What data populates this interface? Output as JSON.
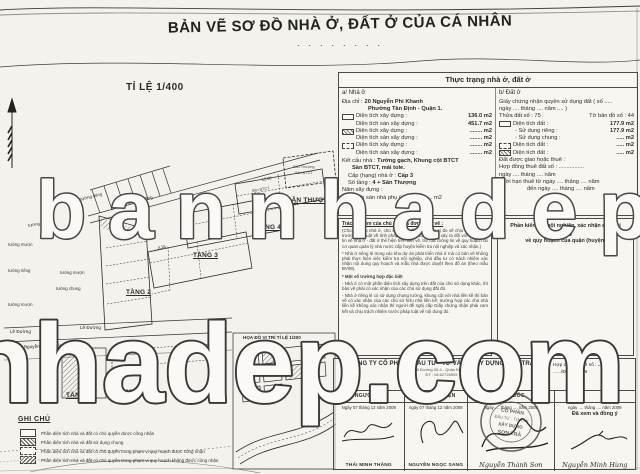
{
  "title": {
    "text": "BẢN VẼ SƠ ĐỒ NHÀ Ở, ĐẤT Ở CỦA CÁ NHÂN",
    "dots": "· · ·   · · · · ·"
  },
  "watermark": {
    "line1": "bannhadep.com",
    "line2": "nhadep.com"
  },
  "plan": {
    "scale_label": "TỈ LỆ 1/400",
    "location_map_label": "HỌA ĐỒ VỊ TRÍ TỈ LỆ 1/200",
    "floor_labels": [
      "TẦNG 1",
      "TẦNG 2",
      "TẦNG 3",
      "TẦNG 4",
      "SÂN THƯỢNG"
    ],
    "street_left": "Lề Đường",
    "street_right": "Lề Đường",
    "street_name": "Đường Nguyễn Phi Khanh",
    "alley_label": "hẻm xi măng",
    "slab_label": "Sàn BTCT",
    "roof_lines": [
      "Sân Thượng",
      "Sàn BTCT"
    ],
    "wall_labels": [
      "tường riêng",
      "tường mượn",
      "tường riêng",
      "tường mượn",
      "tường chung",
      "tường mượn",
      "tường riêng"
    ],
    "dims": [
      "10.00",
      "12.00",
      "4.10",
      "3.96"
    ]
  },
  "form": {
    "header": "Thực trạng nhà ở, đất ở",
    "house": {
      "section": "a/ Nhà ở",
      "address_label": "Địa chỉ :",
      "address1": "20 Nguyễn Phi Khanh",
      "address2": "Phường Tân Định - Quận 1.",
      "rows": [
        {
          "label": "Diện tích xây dựng :",
          "value": "136.0 m2"
        },
        {
          "label": "Diện tích sàn xây dựng :",
          "value": "451.7 m2"
        },
        {
          "label": "Diện tích xây dựng :",
          "value": "........ m2"
        },
        {
          "label": "Diện tích sàn xây dựng :",
          "value": "........ m2"
        },
        {
          "label": "Diện tích xây dựng :",
          "value": "........ m2"
        },
        {
          "label": "Diện tích sàn xây dựng :",
          "value": "........ m2"
        }
      ],
      "structure_label": "Kết cấu nhà :",
      "structure_value": "Tường gạch, Khung cột BTCT",
      "structure_value2": "Sàn BTCT, mái tole.",
      "grade_label": "Cấp (hạng) nhà ở :",
      "grade_value": "Cấp 3",
      "floors_label": "Số tầng :",
      "floors_value": "4 + Sân Thượng",
      "year_label": "Năm xây dựng :",
      "aux_label": "Diện tích sàn nhà phụ (nếu có) ....... m2"
    },
    "land": {
      "section": "b/ Đất ở",
      "cert1": "Giấy chứng nhận quyền sử dụng đất ( số .....",
      "cert2": "ngày .... tháng .... năm .... )",
      "parcel": "Thửa đất số : 75",
      "sheet": "Tờ bản đồ số : 44",
      "rows": [
        {
          "label": "Diện tích đất :",
          "value": "177.9 m2"
        },
        {
          "label": "- Sử dụng riêng :",
          "value": "177.9 m2"
        },
        {
          "label": "- Sử dụng chung :",
          "value": "..... m2"
        },
        {
          "label": "Diện tích đất :",
          "value": "..... m2"
        },
        {
          "label": "Diện tích đất :",
          "value": "..... m2"
        }
      ],
      "granted": "Đất được giao hoặc thuê :",
      "lease1": "Hợp đồng thuê đất số : ................",
      "lease2": "ngày .... tháng .... năm",
      "lease3": "Thời hạn thuê từ ngày .... tháng .... năm",
      "lease4": "đến ngày .... tháng .... năm"
    },
    "responsibility": {
      "title": "Trách nhiệm của chủ nhà và đơn vị đo vẽ :",
      "p1": "(Chủ sở hữu nhà ở, chủ sử dụng đất ở và đơn vị đo vẽ chịu trách nhiệm trước pháp luật về tính pháp lý và mọi tranh chấp xảy ra đối với các thông tin về nhà ở - đất ở thể hiện trên bản vẽ, trừ các thông tin về quy hoạch do cơ quan quản lý nhà nước cấp huyện kiểm tra nội nghiệp và xác nhận.)",
      "p2": "* Nhà ở riêng lẻ trong các khu dự án phát triển nhà ở mà có bản vẽ không phải thực hiện việc kiểm tra nội nghiệp, chủ đầu tư có trách nhiệm xác nhận nội dung quy hoạch và mẫu nhà được duyệt theo đồ án (theo mẫu BV09).",
      "p3_title": "* Một số trường hợp đặc biệt",
      "p3a": "- Nhà ở có một phần diện tích xây dựng trên đất của chủ sử dụng khác, thì bản vẽ phải có xác nhận của các chủ sử dụng đất đó.",
      "p3b": "- Nhà ở riêng lẻ có sử dụng chung tường, khung cột với nhà liền kề thì bản vẽ có xác nhận của các chủ sở hữu nhà liền kề; trường hợp các chủ nhà liền kề không xác nhận thì người đề nghị cấp Giấy chứng nhận phải cam kết và chịu trách nhiệm trước pháp luật về nội dung đó."
    },
    "inspection": {
      "line1": "Phần kiểm tra nội nghiệp, xác nhận các nội dung",
      "line2": "về quy hoạch của quận (huyện)"
    }
  },
  "legend": {
    "header": "GHI CHÚ",
    "items": [
      "Phần diện tích nhà và đất có chủ quyền được công nhận",
      "Phần diện tích nhà và đất sử dụng chung",
      "Phần diện tích nhà và đất có chủ quyền trong phạm vi quy hoạch được công nhận",
      "Phần diện tích nhà và đất có chủ quyền trong phạm vi quy hoạch không được công nhận"
    ]
  },
  "company": {
    "name": "CÔNG TY CỔ PHẦN - ĐẦU TƯ - TƯ VẤN - XÂY DỰNG SƠN TRÀ",
    "address1": "96B/16 Đường 30-4 - Quận Bình Thạnh",
    "address2": "ĐT : 08.62726505",
    "contract_label": "Hợp đồng đo vẽ số :",
    "contract_no": "........66",
    "contract_ref": "....../ĐVST-2009",
    "roles": [
      "NGƯỜI VẼ",
      "KT THỰC HIỆN",
      "GIÁM ĐỐC",
      ""
    ],
    "dates": [
      "Ngày 07 tháng 12 năm 2009",
      "ngày 07 tháng 12 năm 2009",
      "Ngày .... tháng .... năm 2009",
      "ngày .... tháng .... năm 2009"
    ],
    "approved": "Đã xem và đồng ý",
    "names": [
      "THÁI MINH THẮNG",
      "NGUYỄN NGỌC SANG",
      "Nguyễn Thành Sơn",
      "Nguyễn Minh Hùng"
    ],
    "stamp": [
      "CỔ PHẦN",
      "ĐẦU TƯ - TƯ VẤN",
      "XÂY DỰNG",
      "SƠN TRÀ"
    ]
  }
}
